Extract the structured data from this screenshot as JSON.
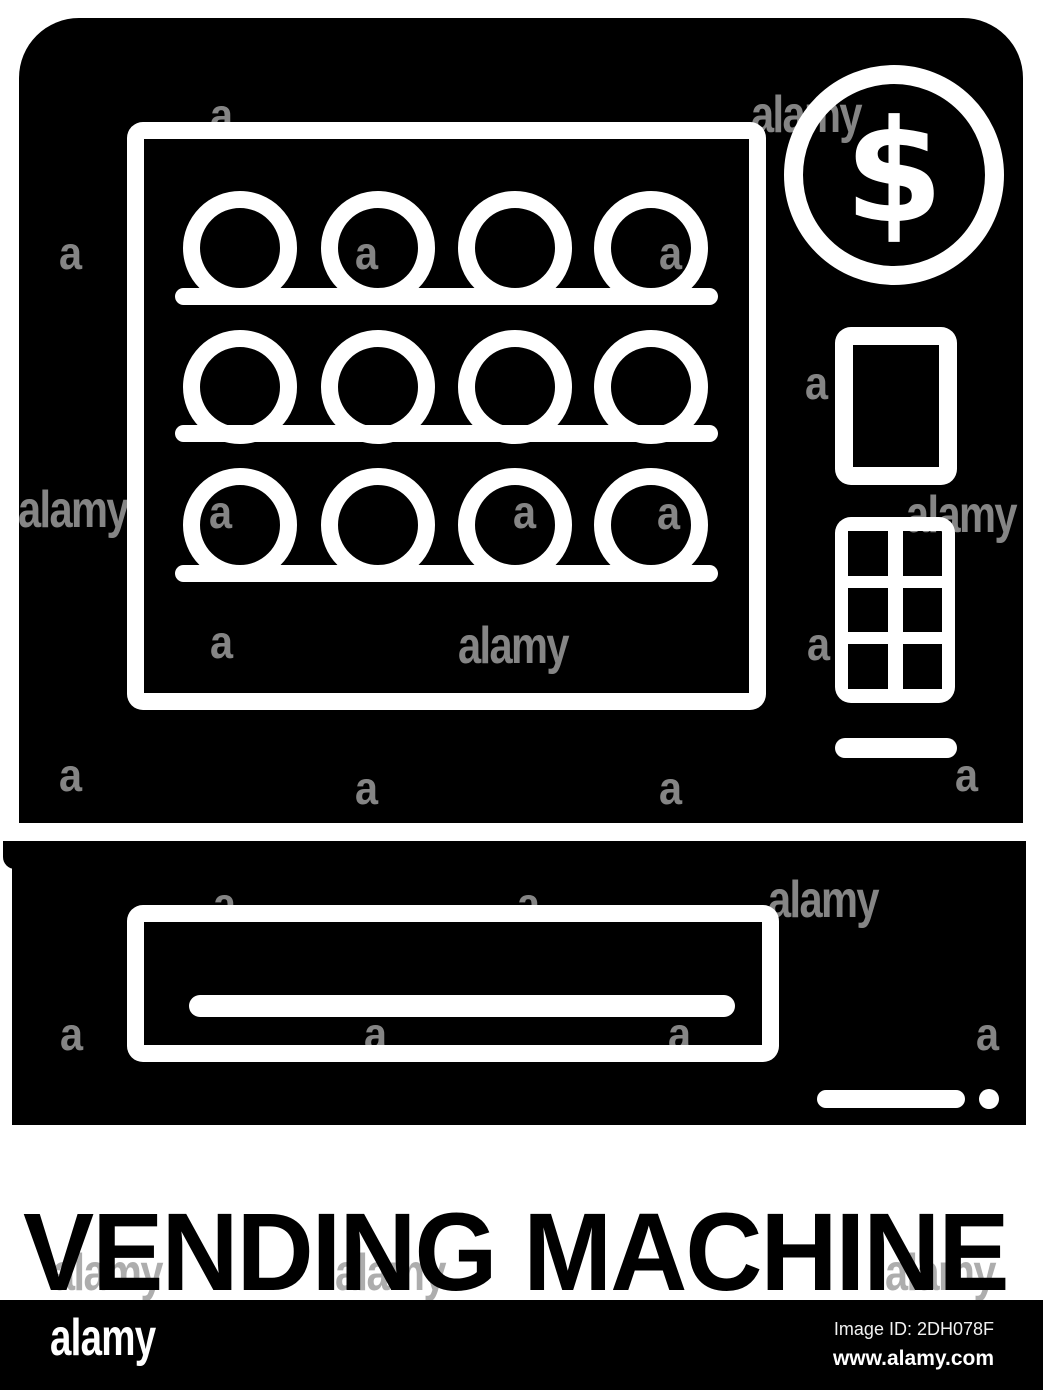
{
  "title": {
    "text": "VENDING MACHINE"
  },
  "icon": {
    "name": "vending-machine-glyph",
    "glyph_color": "#000000",
    "detail_color": "#ffffff",
    "dollar_sign": "$"
  },
  "footer": {
    "logo_text": "alamy",
    "image_id_line": "Image ID: 2DH078F",
    "website": "www.alamy.com",
    "bar_color": "#000000",
    "text_color": "#ffffff"
  },
  "watermark": {
    "word": "alamy",
    "letter": "a",
    "color_on_dark": "rgba(255,255,255,0.52)",
    "color_on_light": "rgba(0,0,0,0.32)",
    "words_on_dark": [
      [
        18,
        484
      ],
      [
        906,
        489
      ],
      [
        751,
        89
      ],
      [
        458,
        620
      ],
      [
        768,
        874
      ]
    ],
    "words_on_light": [
      [
        52,
        1247
      ],
      [
        335,
        1247
      ],
      [
        885,
        1247
      ]
    ],
    "letters_on_dark": [
      [
        210,
        92
      ],
      [
        59,
        230
      ],
      [
        355,
        230
      ],
      [
        659,
        230
      ],
      [
        805,
        360
      ],
      [
        209,
        489
      ],
      [
        513,
        489
      ],
      [
        657,
        490
      ],
      [
        210,
        619
      ],
      [
        807,
        621
      ],
      [
        59,
        752
      ],
      [
        355,
        765
      ],
      [
        659,
        765
      ],
      [
        955,
        752
      ],
      [
        213,
        881
      ],
      [
        517,
        881
      ],
      [
        60,
        1011
      ],
      [
        364,
        1011
      ],
      [
        668,
        1011
      ],
      [
        976,
        1011
      ]
    ]
  }
}
